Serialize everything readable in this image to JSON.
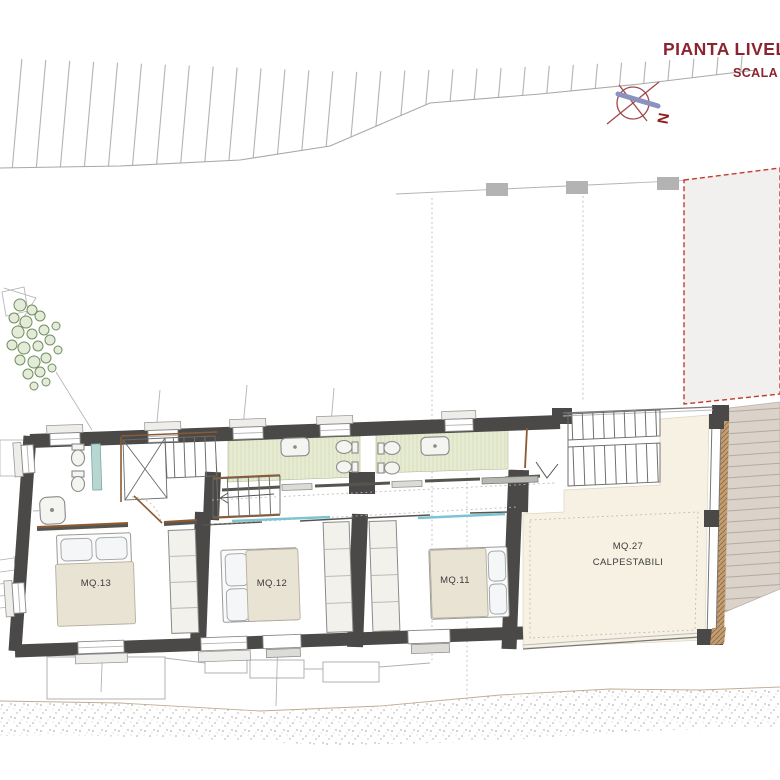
{
  "title": {
    "text": "PIANTA LIVELL",
    "subtitle": "SCALA 1"
  },
  "compass": {
    "north": "N"
  },
  "rooms": {
    "bedroom_left": {
      "label": "MQ.13"
    },
    "bedroom_middle": {
      "label": "MQ.12"
    },
    "bedroom_right": {
      "label": "MQ.11"
    },
    "terrace": {
      "label_line1": "MQ.27",
      "label_line2": "CALPESTABILI"
    }
  },
  "colors": {
    "title_accent": "#8a2430",
    "wall": "#4a4947",
    "bath_floor": "#e6ebd2",
    "terrace_floor": "#f6f1e2",
    "deck": "#dbd3ca",
    "wood_accent": "#8b5a33",
    "dashed_zone": "#c23b2e",
    "glass_partition": "#7cc4d4",
    "bed_cover": "#e9e3d3"
  }
}
